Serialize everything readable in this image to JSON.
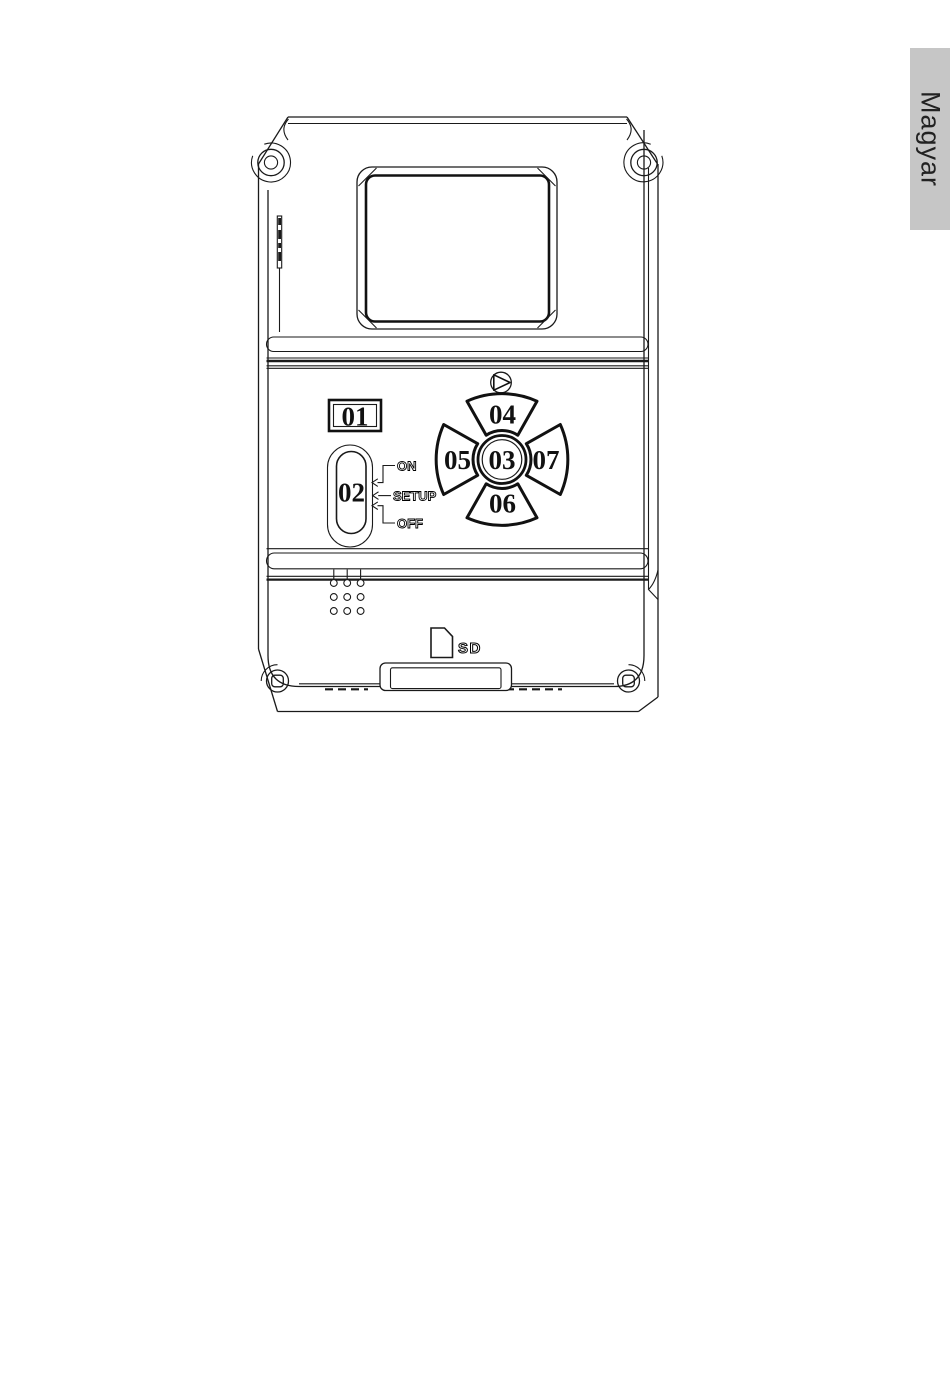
{
  "page": {
    "background": "#ffffff",
    "ink": "#1a1a1a"
  },
  "language_tab": {
    "label": "Magyar",
    "background": "#c6c6c6",
    "text_color": "#222222"
  },
  "diagram": {
    "callouts": [
      "01",
      "02",
      "03",
      "04",
      "05",
      "06",
      "07"
    ],
    "switch_labels": {
      "on": "ON",
      "setup": "SETUP",
      "off": "OFF"
    },
    "sd_label": "SD",
    "icons": {
      "play": "play-icon",
      "sd_card": "sd-card-icon",
      "corner_screws": "corner-screw-icon",
      "speaker": "speaker-holes"
    }
  }
}
